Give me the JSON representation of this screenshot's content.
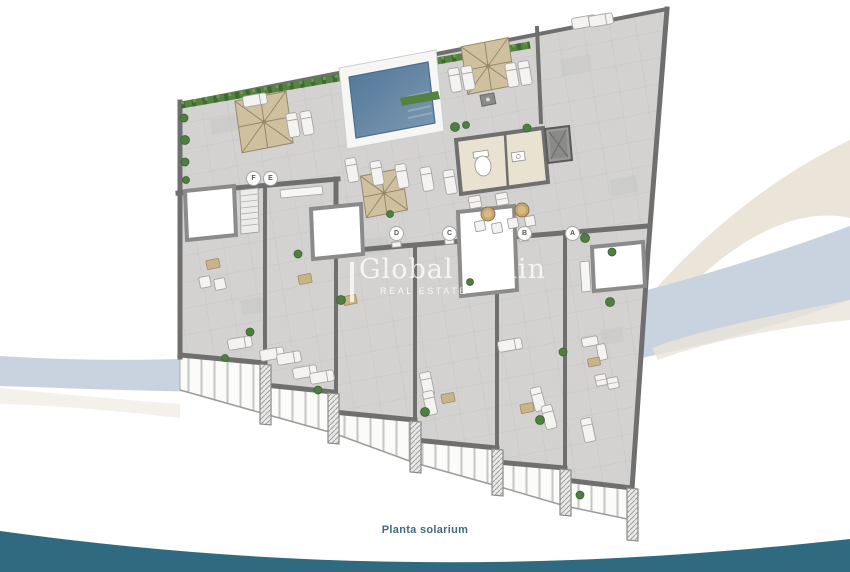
{
  "watermark": {
    "title": "Global Spain",
    "subtitle": "REAL ESTATE"
  },
  "caption": "Planta solarium",
  "plan": {
    "markers": [
      "F",
      "E",
      "D",
      "C",
      "B",
      "A"
    ]
  },
  "colors": {
    "teal_band": "#2f6a80",
    "swoosh_blue": "#c9d3e0",
    "swoosh_cream": "#ebe5d9",
    "pool_dark": "#51769a",
    "pool_light": "#7e9ab1",
    "hedge": "#55823f",
    "plant": "#4f7f3f",
    "floor": "#d3d2d0",
    "wall": "#6f6f6f",
    "parasol": "#cfc0a0",
    "caption_color": "#3f6b7d"
  }
}
